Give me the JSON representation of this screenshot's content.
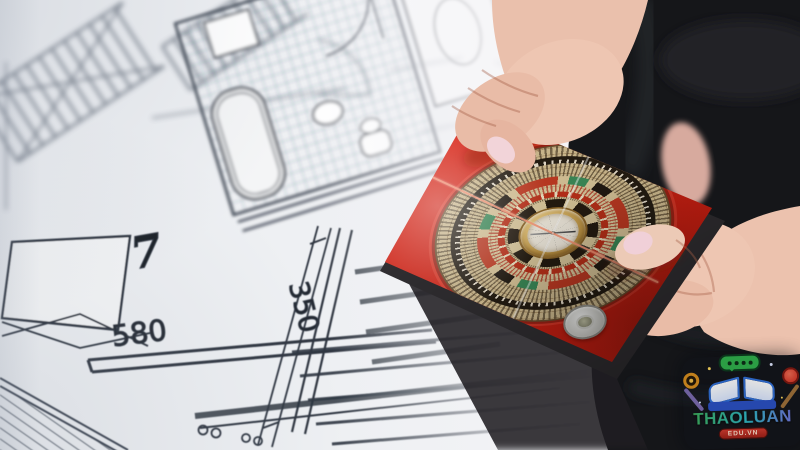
{
  "scene": {
    "type": "photograph",
    "subject": "Hands holding a red feng shui luopan compass over an architectural floor plan"
  },
  "floorplan": {
    "room_number": "7",
    "dim_width": "580",
    "dim_height": "350",
    "paper_color": "#eef0f3",
    "ink_color": "#39414d"
  },
  "compass": {
    "frame_color": "#dd2517",
    "dial_base_color": "#cfbb8f",
    "ring_colors": {
      "black_band": "#241c12",
      "red": "#bf3a22",
      "green": "#3c8a58",
      "gold": "#c59c4a",
      "center_face": "#f2ecdf"
    },
    "needle_color": "#3c3c3c",
    "thread_color": "#f89676"
  },
  "person": {
    "clothing_color": "#151619",
    "skin_color": "#ecc4b0",
    "nail_color": "#f2d4d9"
  },
  "watermark": {
    "title": "THAOLUAN",
    "domain": "EDU.VN",
    "title_gradient": [
      "#3fae49",
      "#2fb9c9",
      "#7d68de"
    ],
    "banner_color": "#c8342c",
    "bubble_color": "#2fb14c",
    "book_color": "#2f6fd8"
  }
}
